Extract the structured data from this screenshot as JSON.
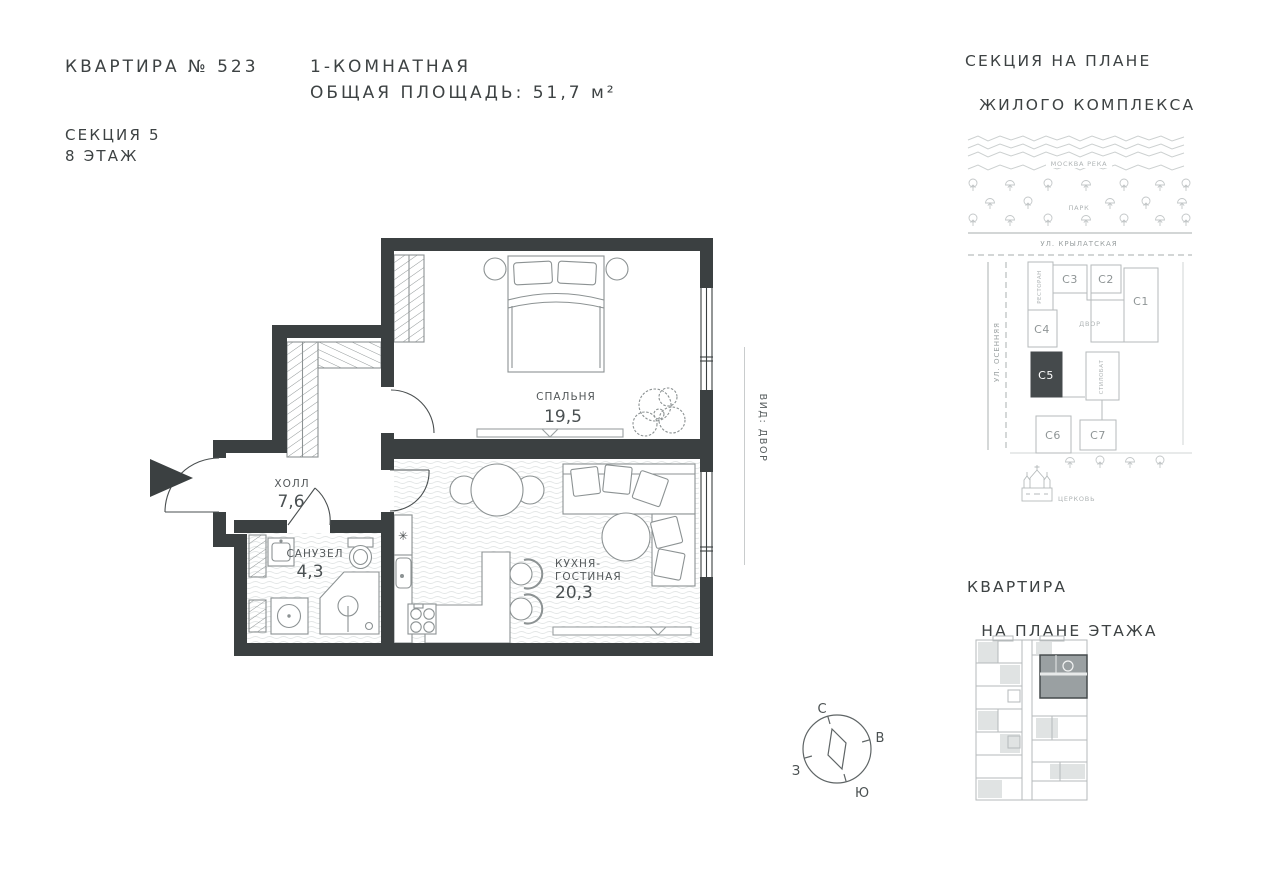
{
  "header": {
    "apartment_title": "КВАРТИРА № 523",
    "rooms_line": "1-КОМНАТНАЯ",
    "area_line": "ОБЩАЯ ПЛОЩАДЬ: 51,7 м²",
    "section_line": "СЕКЦИЯ 5",
    "floor_line": "8 ЭТАЖ"
  },
  "floor_plan": {
    "rooms": {
      "bedroom": {
        "label": "СПАЛЬНЯ",
        "area": "19,5"
      },
      "hall": {
        "label": "ХОЛЛ",
        "area": "7,6"
      },
      "bathroom": {
        "label": "САНУЗЕЛ",
        "area": "4,3"
      },
      "kitchen": {
        "label_line1": "КУХНЯ-",
        "label_line2": "ГОСТИНАЯ",
        "area": "20,3"
      }
    },
    "view_label": "ВИД: ДВОР",
    "icons": {
      "fridge": "✳"
    }
  },
  "compass": {
    "north": "С",
    "east": "В",
    "south": "Ю",
    "west": "З"
  },
  "site_map": {
    "title_line1": "СЕКЦИЯ НА ПЛАНЕ",
    "title_line2": "ЖИЛОГО КОМПЛЕКСА",
    "river": "МОСКВА РЕКА",
    "park": "ПАРК",
    "street_top": "УЛ. КРЫЛАТСКАЯ",
    "street_left": "УЛ. ОСЕННЯЯ",
    "courtyard": "ДВОР",
    "restaurant": "РЕСТОРАН",
    "stylobate": "СТИЛОБАТ",
    "church": "ЦЕРКОВЬ",
    "sections": {
      "c1": "С1",
      "c2": "С2",
      "c3": "С3",
      "c4": "С4",
      "c5": "С5",
      "c6": "С6",
      "c7": "С7"
    },
    "highlighted_section": "С5"
  },
  "floor_thumbnail": {
    "title_line1": "КВАРТИРА",
    "title_line2": "НА ПЛАНЕ ЭТАЖА"
  },
  "colors": {
    "walls": "#3b4041",
    "text": "#3d4243",
    "light_line": "#b5babb",
    "furniture_line": "#8c9293",
    "texture_line": "#e3e6e6",
    "highlight_fill": "#9aa0a2",
    "section_highlight": "#454a4c"
  }
}
